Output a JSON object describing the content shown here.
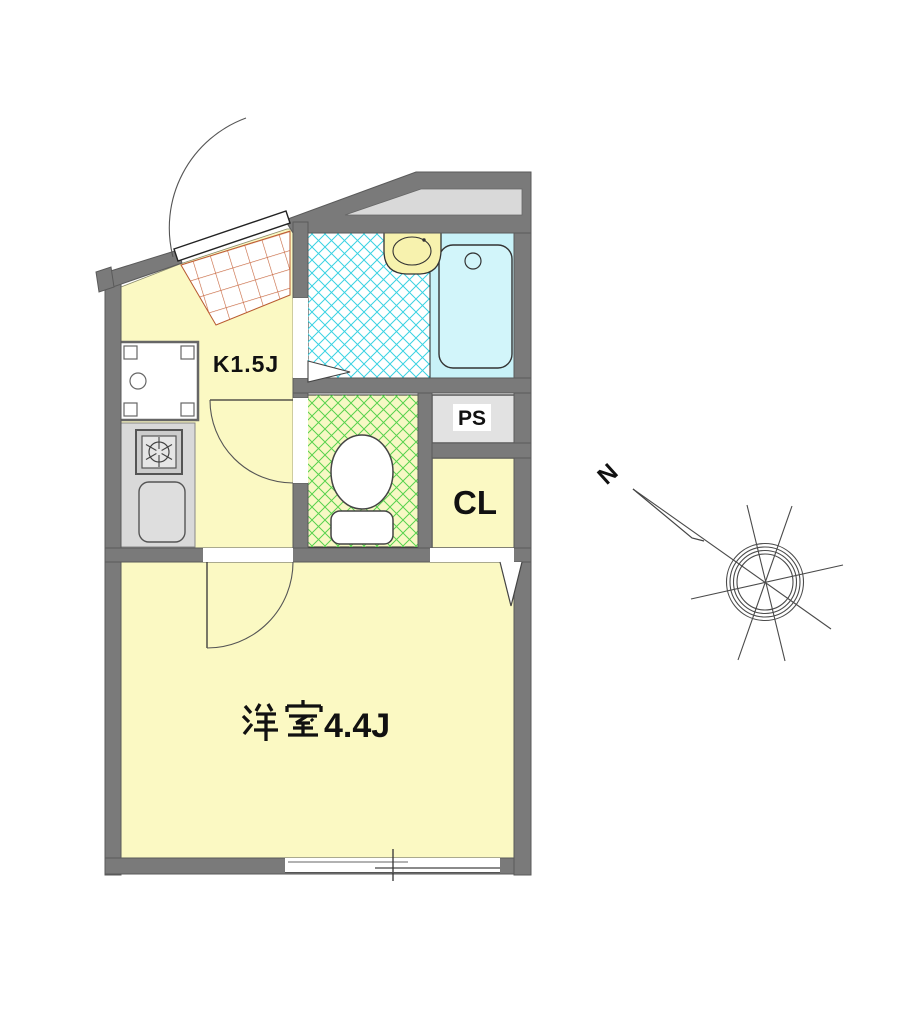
{
  "rooms": {
    "kitchen": {
      "label": "K1.5J"
    },
    "main": {
      "label": "洋室4.4J",
      "name_ja": "洋室",
      "size": "4.4J"
    },
    "pipe_space": {
      "label": "PS"
    },
    "closet": {
      "label": "CL"
    },
    "bathroom": {
      "fixtures": [
        "bathtub",
        "washbasin",
        "folding-door"
      ]
    },
    "toilet": {
      "fixtures": [
        "toilet-bowl"
      ]
    },
    "entrance": {
      "fixtures": [
        "entrance-door",
        "tile-floor"
      ]
    }
  },
  "kitchen_fixtures": [
    "washing-machine-pan",
    "stove-burner",
    "kitchen-sink",
    "counter"
  ],
  "window": {
    "type": "sliding-window"
  },
  "compass": {
    "north": "N"
  },
  "colors": {
    "wall": "#7a7a7a",
    "floor_yellow": "#fbf9c3",
    "bath_fill": "#c8f2f8",
    "bath_hatch": "#3ad2e2",
    "toilet_floor": "#f7f8c4",
    "toilet_hatch": "#58d24e",
    "entrance_tile_hatch": "#c6633a",
    "counter_gray": "#d9d9d9",
    "alcove_gray": "#d9d9d9"
  }
}
